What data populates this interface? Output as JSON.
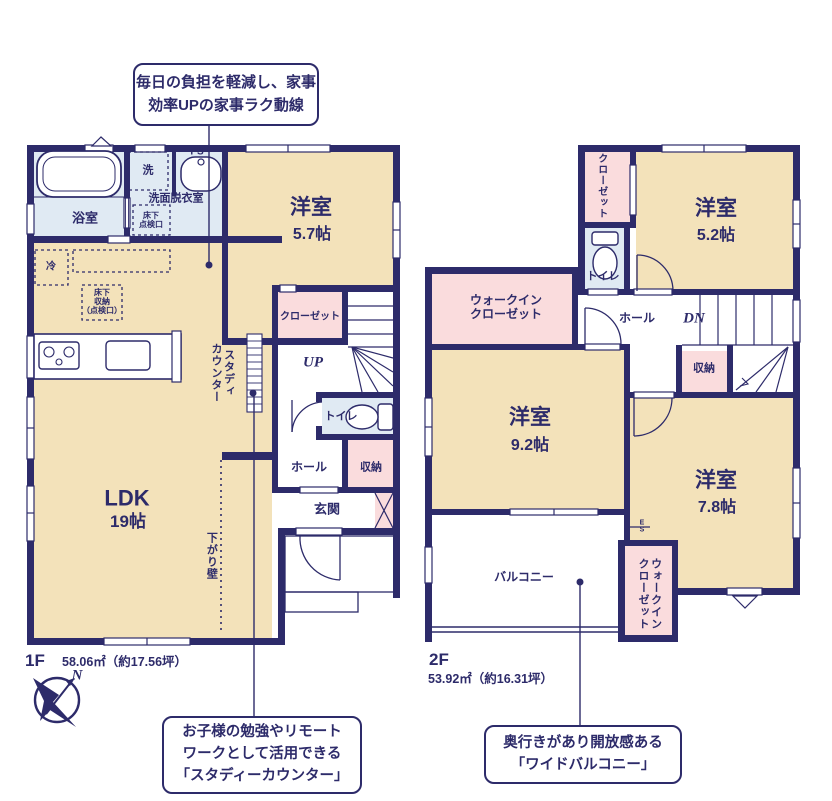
{
  "colors": {
    "wall_navy": "#2d2b6a",
    "room_beige": "#f3e2ba",
    "closet_pink": "#fadcdd",
    "wet_blue": "#e0eaf3",
    "background": "#ffffff"
  },
  "compass": {
    "north_label": "N"
  },
  "callouts": {
    "housework": {
      "lines": [
        "毎日の負担を軽減し、家事",
        "効率UPの家事ラク動線"
      ]
    },
    "study": {
      "lines": [
        "お子様の勉強やリモート",
        "ワークとして活用できる",
        "「スタディーカウンター」"
      ]
    },
    "balcony": {
      "lines": [
        "奥行きがあり開放感ある",
        "「ワイドバルコニー」"
      ]
    }
  },
  "floor1": {
    "name": "1F",
    "area": "58.06㎡（約17.56坪）",
    "labels": {
      "ps": "PS",
      "washer": "洗",
      "laundry_room": "洗面脱衣室",
      "bath": "浴室",
      "underfloor_access": [
        "床下",
        "点検口"
      ],
      "fridge": "冷",
      "underfloor_storage": [
        "床下",
        "収納",
        "（点検口）"
      ],
      "bedroom": "洋室",
      "bedroom_size": "5.7帖",
      "closet": "クローゼット",
      "up": "UP",
      "toilet": "トイレ",
      "hall": "ホール",
      "storage": "収納",
      "entrance": "玄関",
      "ldk": "LDK",
      "ldk_size": "19帖",
      "study_counter": [
        "スタディ",
        "カウンター"
      ],
      "lowered_wall": "下がり壁"
    }
  },
  "floor2": {
    "name": "2F",
    "area": "53.92㎡（約16.31坪）",
    "labels": {
      "closet": "クローゼット",
      "toilet": "トイレ",
      "bedroom52": "洋室",
      "bedroom52_size": "5.2帖",
      "wic": [
        "ウォークイン",
        "クローゼット"
      ],
      "hall": "ホール",
      "dn": "DN",
      "storage": "収納",
      "bedroom92": "洋室",
      "bedroom92_size": "9.2帖",
      "bedroom78": "洋室",
      "bedroom78_size": "7.8帖",
      "es": [
        "E",
        "S"
      ],
      "wic2": [
        "ウォークイン",
        "クローゼット"
      ],
      "balcony": "バルコニー"
    }
  }
}
